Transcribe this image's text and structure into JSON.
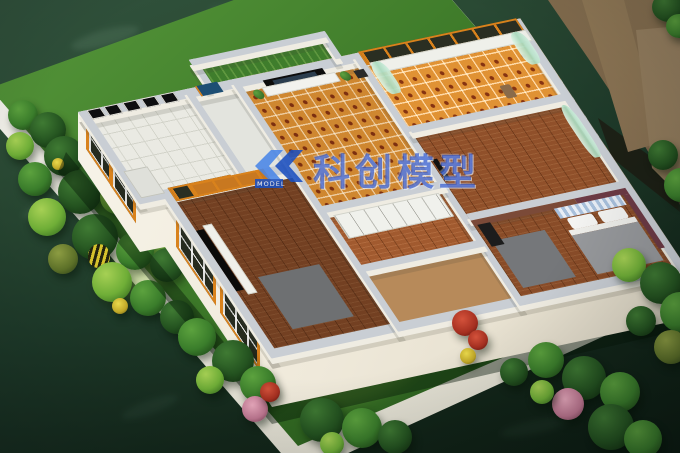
{
  "watermark": {
    "brand": "科创模型",
    "logo_label": "MODEL",
    "color": "#1844c6"
  },
  "colors": {
    "floor_dark": "#1e3a29",
    "platform": "#efeee6",
    "lawn": "#3f7d2c",
    "wall_face": "#f4f0e6",
    "wall_top": "#c9ced4",
    "frame_orange": "#d9821c",
    "tile_orange": "#cf8730",
    "kitchen_tile": "#eaeae3",
    "wood_floor": "#90502a",
    "turf_green": "#3f7d2c",
    "curtain_green": "#bfe4cd",
    "door_blue": "#1d4e73",
    "accent_brown": "#7b4a38",
    "accent_maroon": "#6d3a45",
    "backdrop_wood": "#7a6347"
  }
}
